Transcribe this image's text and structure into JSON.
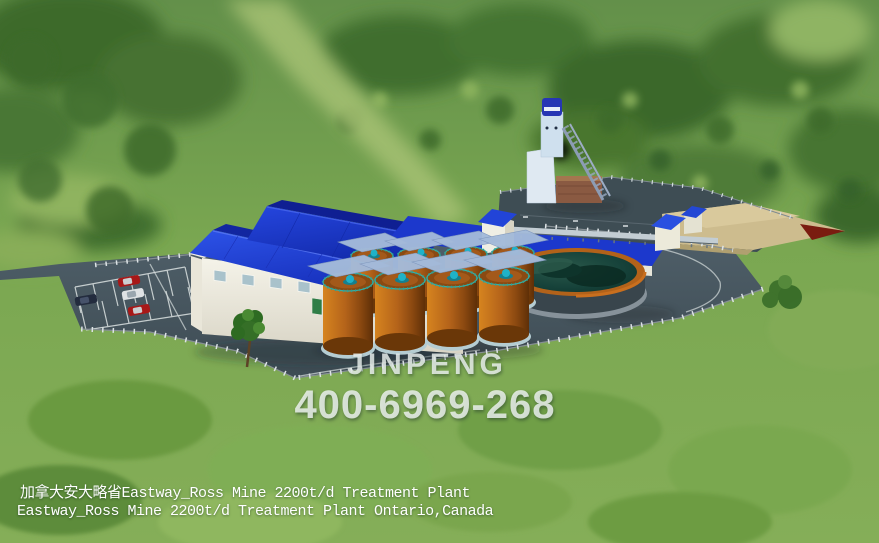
{
  "scene": {
    "type": "3d-aerial-render",
    "subject": "mine treatment plant in a forest clearing",
    "watermark": {
      "brand": "JINPENG",
      "phone": "400-6969-268"
    },
    "captions": {
      "line1": "加拿大安大略省Eastway_Ross Mine 2200t/d Treatment Plant",
      "line2": "Eastway_Ross Mine 2200t/d Treatment Plant Ontario,Canada"
    },
    "counts": {
      "leach_tanks": 8,
      "cars": 4
    },
    "landmarks": [
      "forest-background",
      "clearing-trail",
      "site-pavement",
      "parking-lot",
      "parking-cars",
      "perimeter-fence",
      "main-plant-building",
      "transfer-house",
      "conveyor-gallery",
      "mine-headframe",
      "platform-area",
      "ore-stockpile-pad",
      "stockpile-buildings",
      "thickener-pond",
      "leaching-tanks",
      "trees"
    ],
    "colors": {
      "roof_blue": "#1d3fd0",
      "tank_orange": "#b06018",
      "pond_teal": "#143f35",
      "pavement_gray": "#46555d",
      "platform_gray": "#3e4d54",
      "stockpile_tan": "#cdbc8e",
      "grass_green": "#74a04c",
      "watermark_text": "#edf3f0",
      "caption_text": "#ffffff",
      "car_red": "#a81818",
      "car_white": "#e2e5e6",
      "car_dark": "#232c3e"
    }
  }
}
